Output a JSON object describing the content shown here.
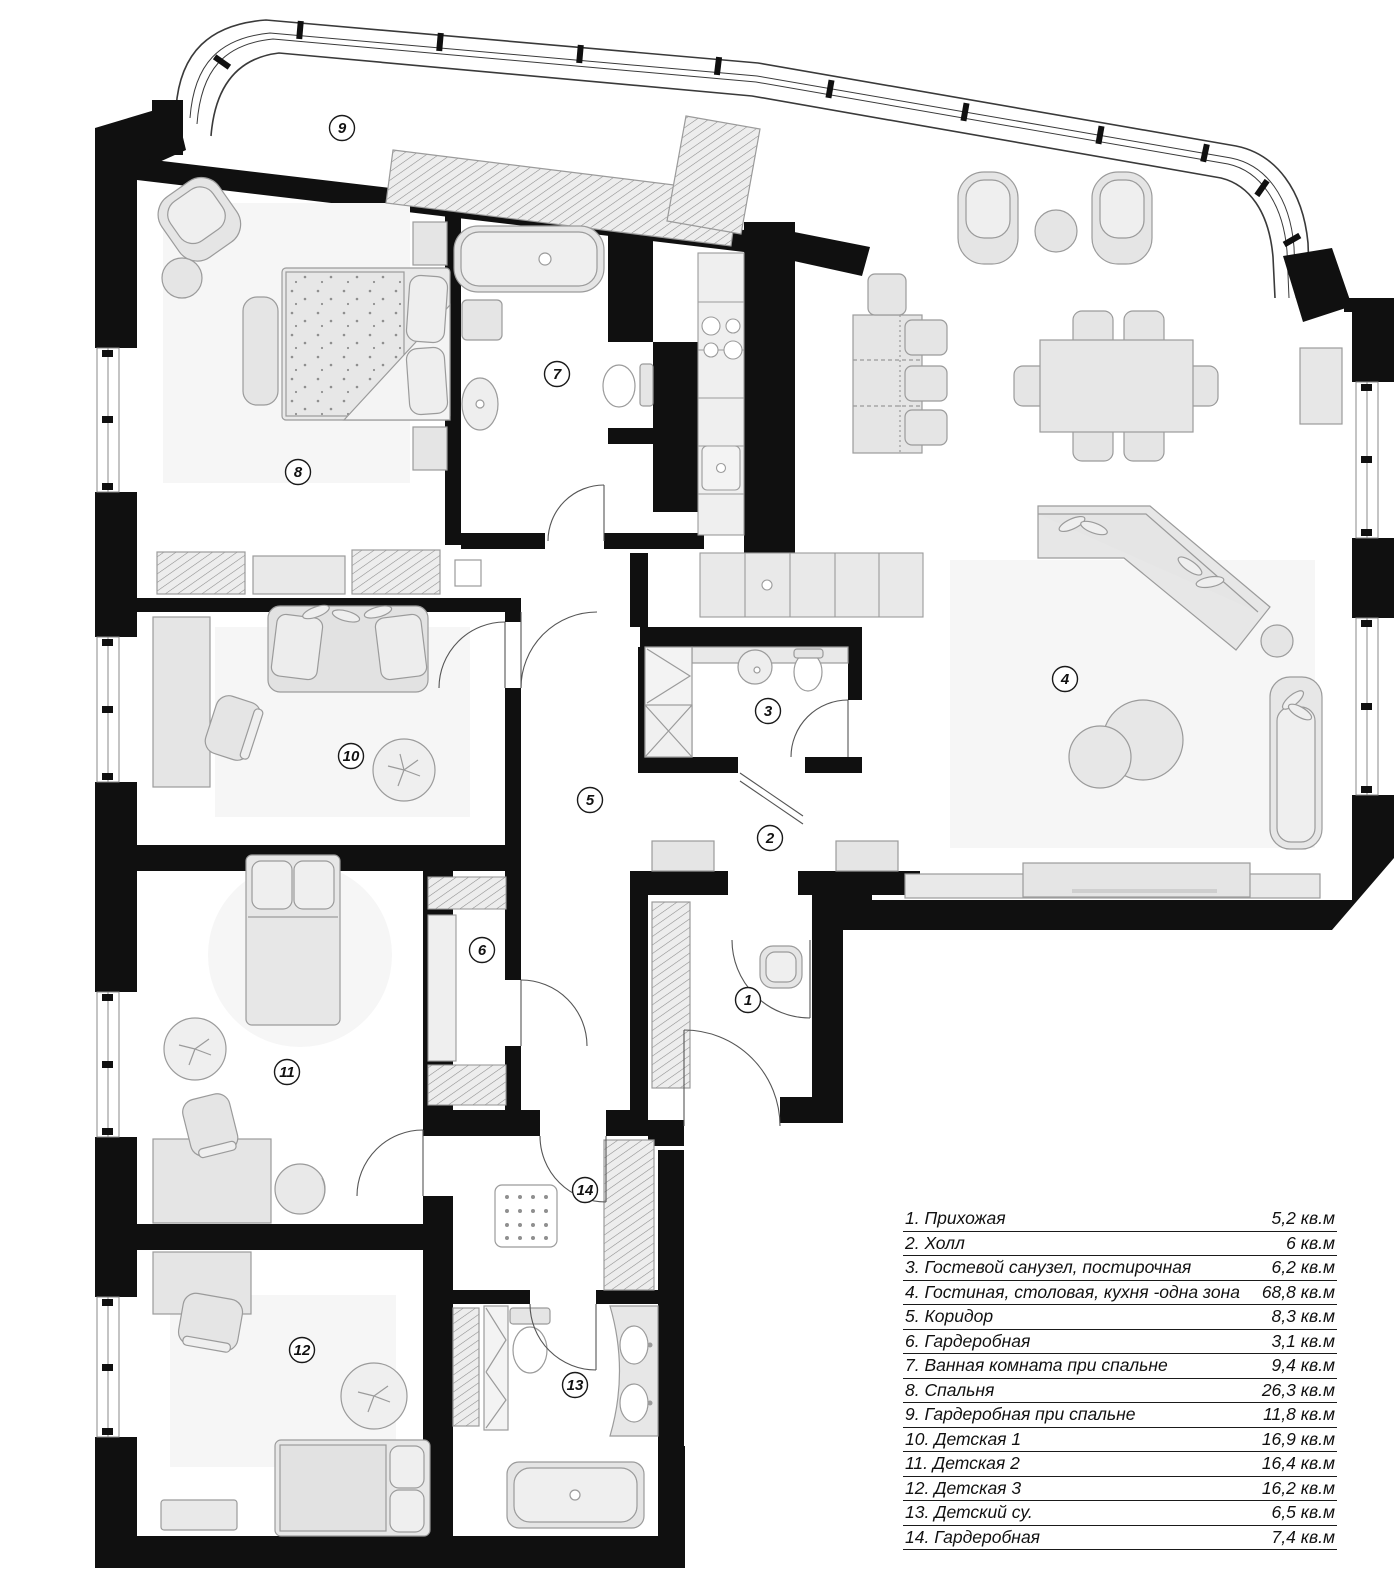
{
  "plan": {
    "rooms": [
      {
        "number": "1",
        "name": "Прихожая",
        "area": "5,2 кв.м",
        "badge": {
          "cx": 748,
          "cy": 1000
        }
      },
      {
        "number": "2",
        "name": "Холл",
        "area": "6 кв.м",
        "badge": {
          "cx": 770,
          "cy": 838
        }
      },
      {
        "number": "3",
        "name": "Гостевой санузел, постирочная",
        "area": "6,2 кв.м",
        "badge": {
          "cx": 768,
          "cy": 711
        }
      },
      {
        "number": "4",
        "name": "Гостиная, столовая, кухня -одна зона",
        "area": "68,8 кв.м",
        "badge": {
          "cx": 1065,
          "cy": 679
        }
      },
      {
        "number": "5",
        "name": "Коридор",
        "area": "8,3 кв.м",
        "badge": {
          "cx": 590,
          "cy": 800
        }
      },
      {
        "number": "6",
        "name": "Гардеробная",
        "area": "3,1 кв.м",
        "badge": {
          "cx": 482,
          "cy": 950
        }
      },
      {
        "number": "7",
        "name": "Ванная комната при спальне",
        "area": "9,4 кв.м",
        "badge": {
          "cx": 557,
          "cy": 374
        }
      },
      {
        "number": "8",
        "name": "Спальня",
        "area": "26,3 кв.м",
        "badge": {
          "cx": 298,
          "cy": 472
        }
      },
      {
        "number": "9",
        "name": "Гардеробная при спальне",
        "area": "11,8 кв.м",
        "badge": {
          "cx": 342,
          "cy": 128
        }
      },
      {
        "number": "10",
        "name": "Детская 1",
        "area": "16,9 кв.м",
        "badge": {
          "cx": 351,
          "cy": 756
        }
      },
      {
        "number": "11",
        "name": "Детская 2",
        "area": "16,4 кв.м",
        "badge": {
          "cx": 287,
          "cy": 1072
        }
      },
      {
        "number": "12",
        "name": "Детская 3",
        "area": "16,2 кв.м",
        "badge": {
          "cx": 302,
          "cy": 1350
        }
      },
      {
        "number": "13",
        "name": "Детский су.",
        "area": "6,5 кв.м",
        "badge": {
          "cx": 575,
          "cy": 1385
        }
      },
      {
        "number": "14",
        "name": "Гардеробная",
        "area": "7,4 кв.м",
        "badge": {
          "cx": 585,
          "cy": 1190
        }
      }
    ],
    "colors": {
      "wall": "#101010",
      "furniture_fill": "#e5e5e5",
      "furniture_stroke": "#9b9b9b",
      "rug": "#f6f6f6",
      "line": "#555555",
      "background": "#ffffff",
      "text": "#111111"
    }
  }
}
